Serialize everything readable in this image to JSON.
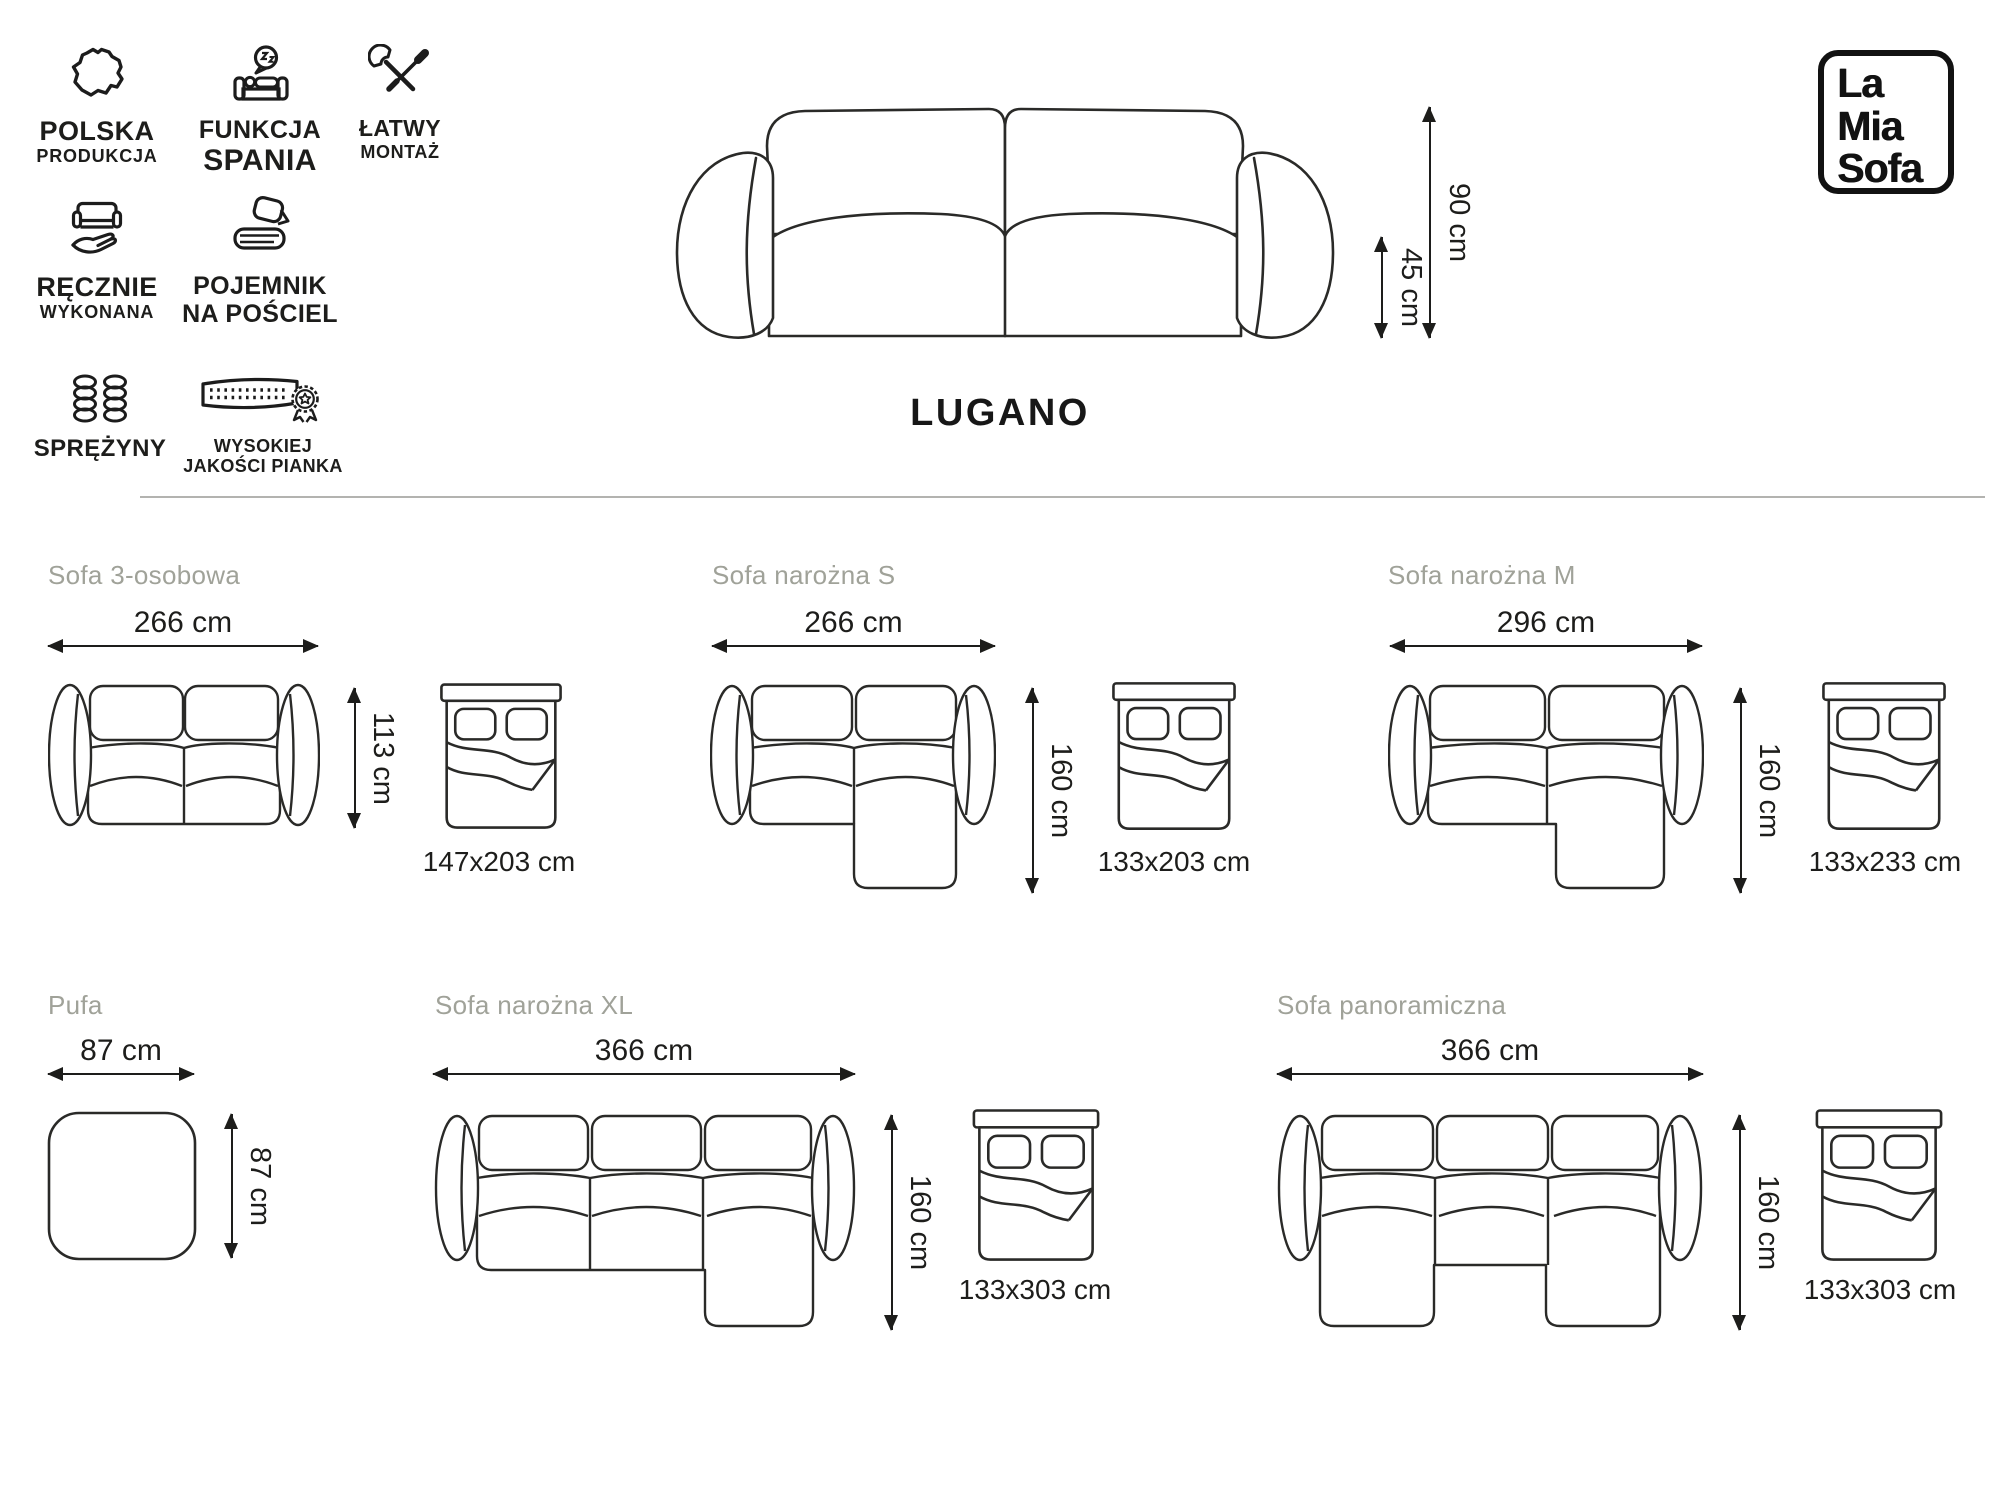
{
  "colors": {
    "ink": "#1d1d1b",
    "muted_title": "#a0a299",
    "divider": "#b3b3b0",
    "drawing_line": "#2a2a28"
  },
  "logo": {
    "lines": [
      "La",
      "Mia",
      "Sofa"
    ]
  },
  "hero": {
    "product_name": "LUGANO",
    "height": "90 cm",
    "seat_height": "45 cm"
  },
  "features": [
    {
      "icon": "poland-map-icon",
      "line1": "POLSKA",
      "line2": "PRODUKCJA"
    },
    {
      "icon": "sleep-function-icon",
      "line1": "FUNKCJA",
      "line2": "SPANIA"
    },
    {
      "icon": "easy-assembly-icon",
      "line1": "ŁATWY",
      "line2": "MONTAŻ"
    },
    {
      "icon": "handmade-icon",
      "line1": "RĘCZNIE",
      "line2": "WYKONANA"
    },
    {
      "icon": "bedding-container-icon",
      "line1": "POJEMNIK",
      "line2": "NA POŚCIEL"
    },
    {
      "icon": "springs-icon",
      "line1": "SPRĘŻYNY",
      "line2": ""
    },
    {
      "icon": "quality-foam-icon",
      "line1": "WYSOKIEJ",
      "line2": "JAKOŚCI PIANKA"
    }
  ],
  "variants": [
    {
      "name": "Sofa 3-osobowa",
      "width": "266 cm",
      "depth": "113 cm",
      "bed_size": "147x203 cm"
    },
    {
      "name": "Sofa narożna S",
      "width": "266 cm",
      "depth": "160 cm",
      "bed_size": "133x203 cm"
    },
    {
      "name": "Sofa narożna M",
      "width": "296 cm",
      "depth": "160 cm",
      "bed_size": "133x233 cm"
    },
    {
      "name": "Pufa",
      "width": "87 cm",
      "depth": "87 cm",
      "bed_size": ""
    },
    {
      "name": "Sofa narożna XL",
      "width": "366 cm",
      "depth": "160 cm",
      "bed_size": "133x303 cm"
    },
    {
      "name": "Sofa panoramiczna",
      "width": "366 cm",
      "depth": "160 cm",
      "bed_size": "133x303 cm"
    }
  ]
}
